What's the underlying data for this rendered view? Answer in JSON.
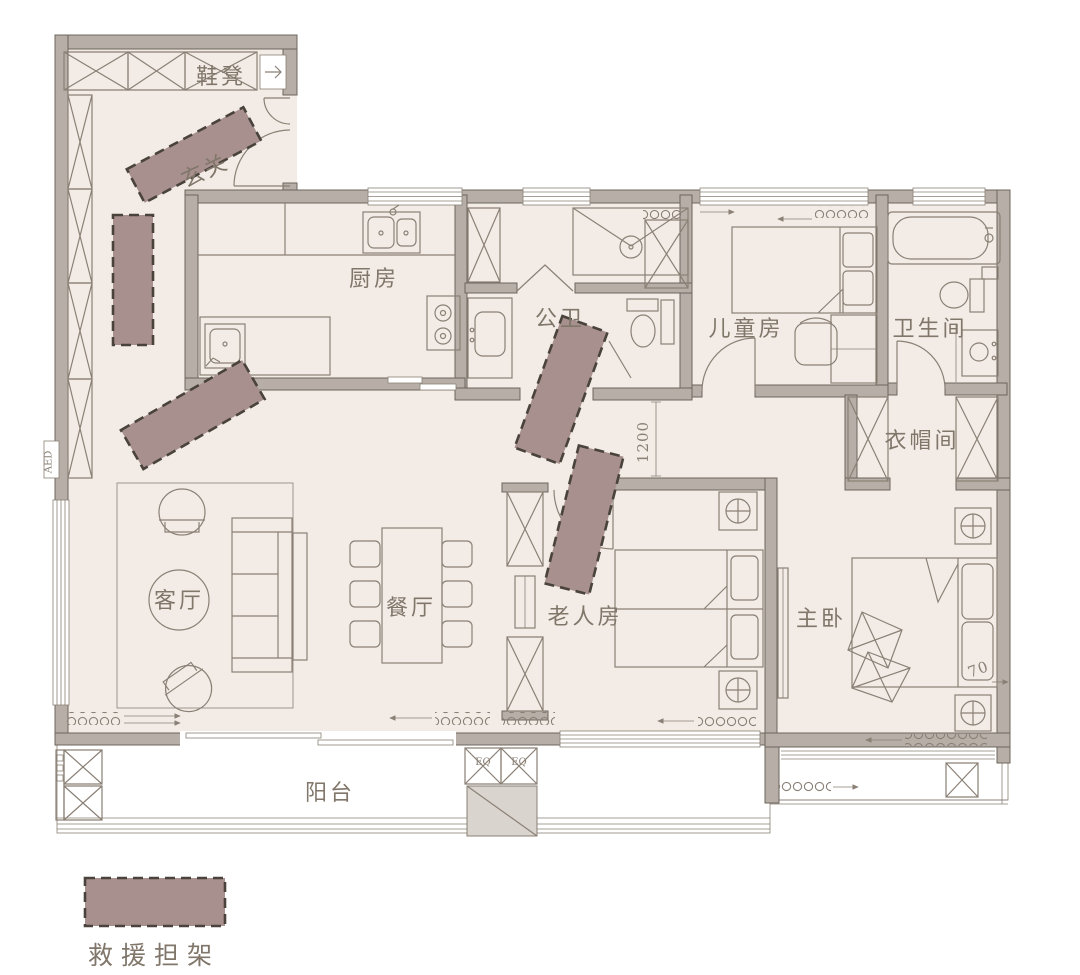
{
  "rooms": {
    "entry": "玄关",
    "shoe_bench": "鞋凳",
    "kitchen": "厨房",
    "public_bath": "公卫",
    "kids_room": "儿童房",
    "bathroom": "卫生间",
    "cloakroom": "衣帽间",
    "living_room": "客厅",
    "dining_room": "餐厅",
    "elder_room": "老人房",
    "master_bedroom": "主卧",
    "balcony": "阳台"
  },
  "legend": {
    "stretcher": "救援担架"
  },
  "dimensions": {
    "corridor_width": "1200",
    "bed_clearance": "70"
  },
  "equipment": {
    "aed": "AED",
    "eq_left": "EQ",
    "eq_right": "EQ"
  },
  "colors": {
    "floor": "#f3ece6",
    "wall": "#b7afa7",
    "line": "#8a8076",
    "text": "#80766a",
    "stretcher": "#a8908e",
    "stretcherBorder": "#49433c"
  }
}
